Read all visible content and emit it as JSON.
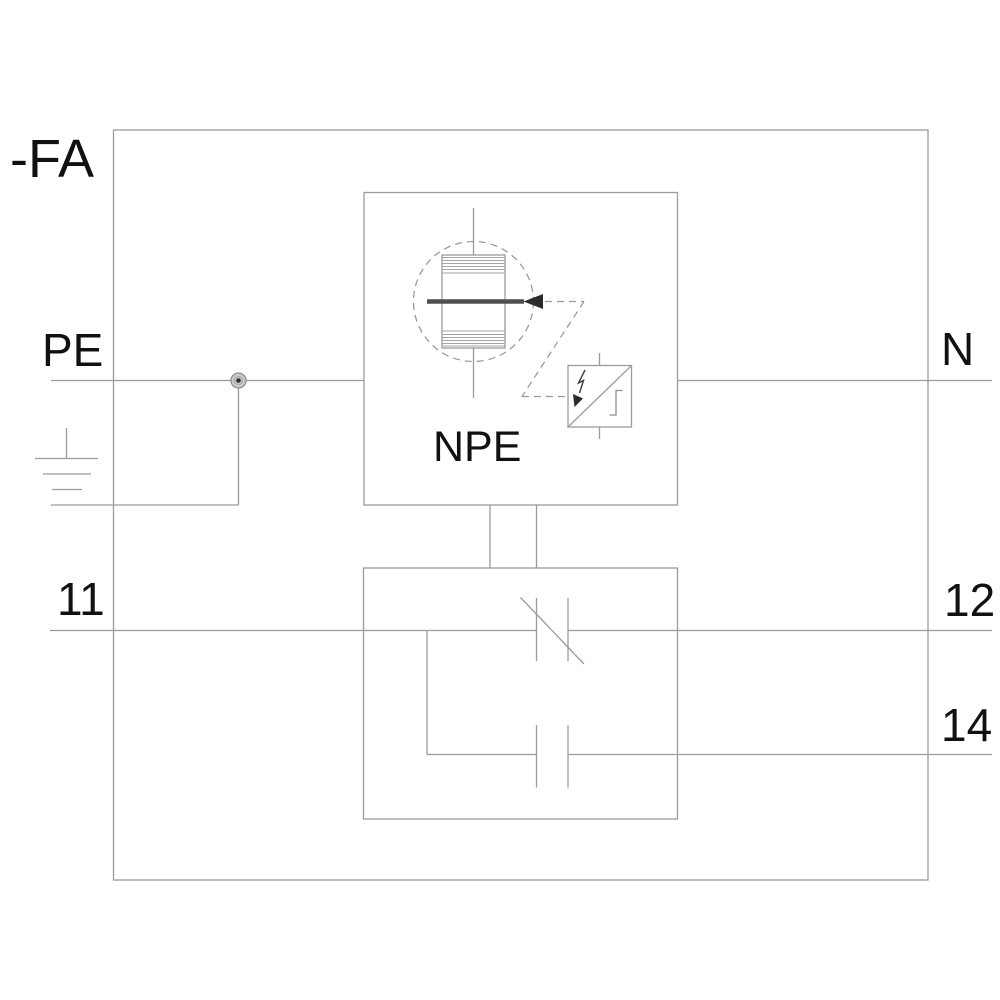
{
  "diagram": {
    "device_tag": "-FA",
    "module_label": "NPE",
    "terminals": {
      "pe": "PE",
      "n": "N",
      "t11": "11",
      "t12": "12",
      "t14": "14"
    },
    "symbols": {
      "earth_ground": "earth-ground-icon",
      "junction": "junction-dot",
      "spark_gap": "spark-gap-arrester-icon",
      "disconnector": "surge-disconnector-icon",
      "lightning": "lightning-arrow-icon",
      "nc_contact": "nc-break-contact-icon",
      "no_contact": "no-make-contact-icon"
    },
    "colors": {
      "background": "#ffffff",
      "line_gray": "#9b9b9b",
      "dark": "#2b2b2b",
      "text": "#111111"
    }
  }
}
